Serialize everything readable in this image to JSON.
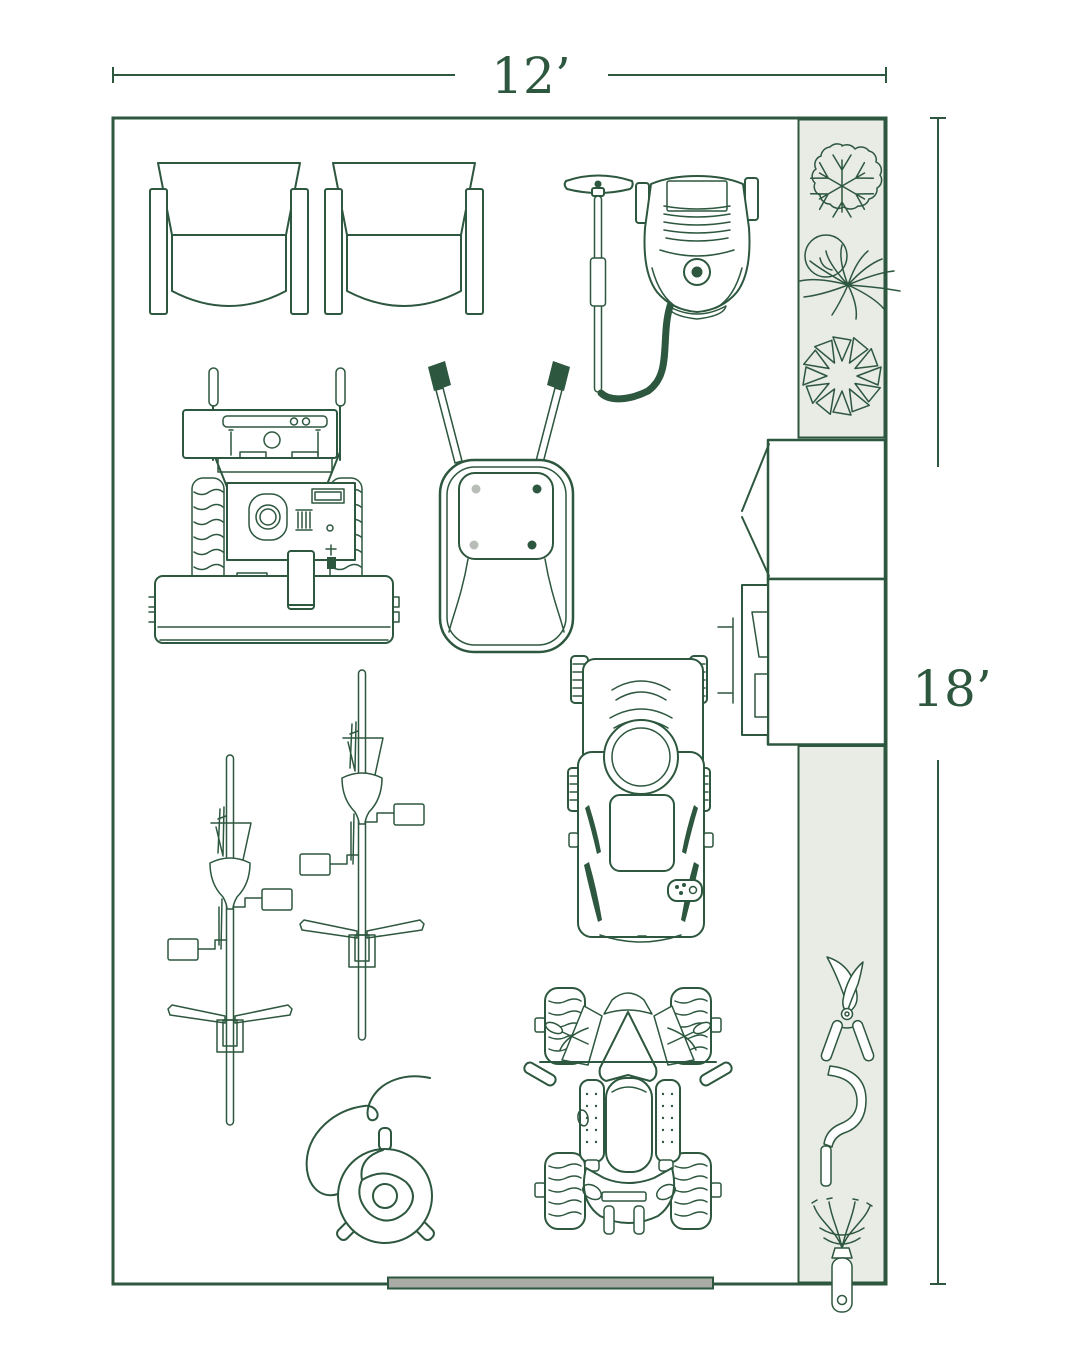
{
  "theme": {
    "ink": "#2D573E",
    "paper": "#FFFFFF",
    "zone_fill": "#E9EBE5",
    "door_fill": "#A9ACA6",
    "bolt_gray": "#B9BDB7"
  },
  "dimensions": {
    "width": {
      "label": "12’"
    },
    "height": {
      "label": "18’"
    }
  },
  "floor_plan": {
    "room": {
      "width_ft": 12,
      "height_ft": 18
    },
    "equipment": [
      {
        "name": "armchair",
        "count": 2
      },
      {
        "name": "pressure-washer-with-wand-and-hose",
        "count": 1
      },
      {
        "name": "snow-blower",
        "count": 1
      },
      {
        "name": "wheelbarrow",
        "count": 1
      },
      {
        "name": "push-mower",
        "count": 1
      },
      {
        "name": "string-trimmer",
        "count": 2
      },
      {
        "name": "hose-reel",
        "count": 1
      },
      {
        "name": "atv-quad",
        "count": 1
      },
      {
        "name": "storage-cabinet-open-door",
        "count": 1
      },
      {
        "name": "storage-cabinet-with-side-unit",
        "count": 1
      }
    ],
    "plant_symbols": [
      "round-shrub",
      "spiky-plant",
      "pinwheel-shrub"
    ],
    "tool_symbols": [
      "pruning-shears",
      "sickle",
      "hand-cultivator"
    ],
    "door": {
      "position": "bottom-wall"
    }
  }
}
